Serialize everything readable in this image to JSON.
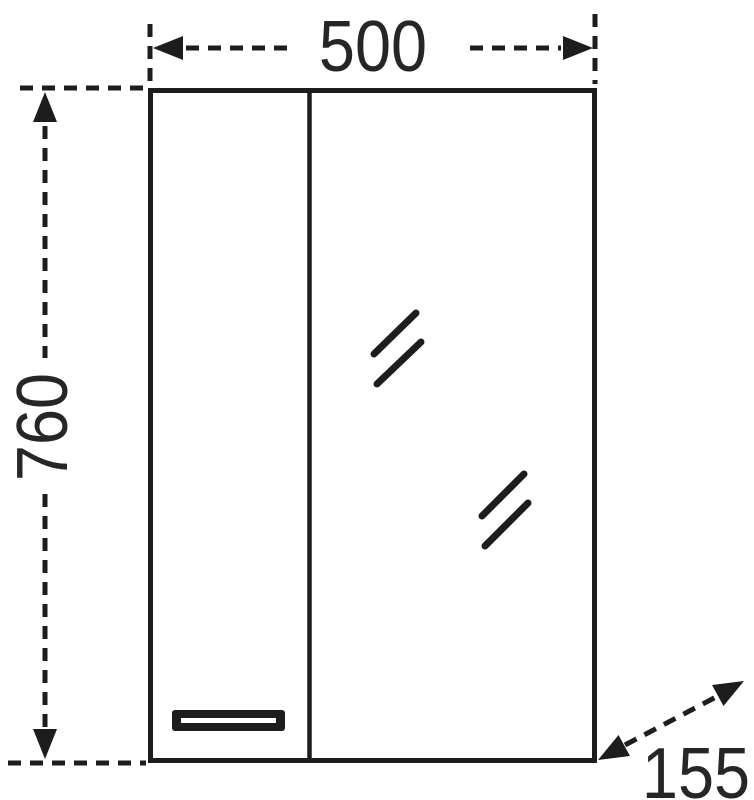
{
  "drawing": {
    "labels": {
      "width": "500",
      "height": "760",
      "depth": "155"
    },
    "colors": {
      "line": "#1d1d1b",
      "text": "#262624",
      "background": "#ffffff"
    }
  }
}
